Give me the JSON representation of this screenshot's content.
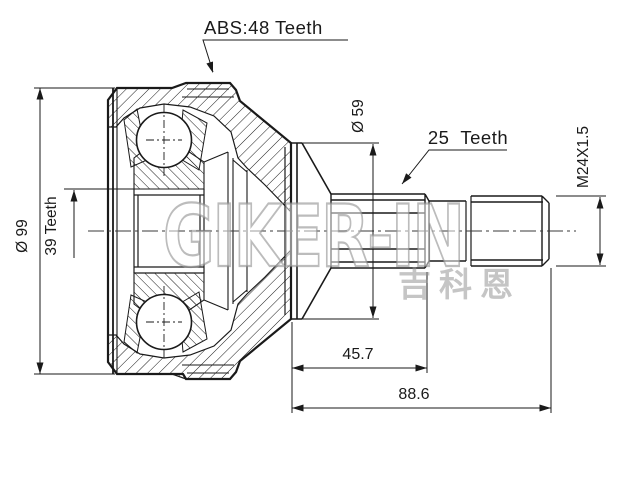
{
  "drawing": {
    "labels": {
      "abs_ring": "ABS:48 Teeth",
      "outer_diameter": "Ø 99",
      "hub_spline": "39 Teeth",
      "boot_diameter": "Ø 59",
      "shaft_spline": "25  Teeth",
      "thread": "M24X1.5",
      "length_to_spline_end": "45.7",
      "length_overall": "88.6"
    },
    "watermark": {
      "logo": "GIKER-IN",
      "cjk": "吉科恩"
    },
    "colors": {
      "line": "#1a1a1a",
      "background": "#ffffff",
      "watermark": "#c8c8c8"
    }
  }
}
